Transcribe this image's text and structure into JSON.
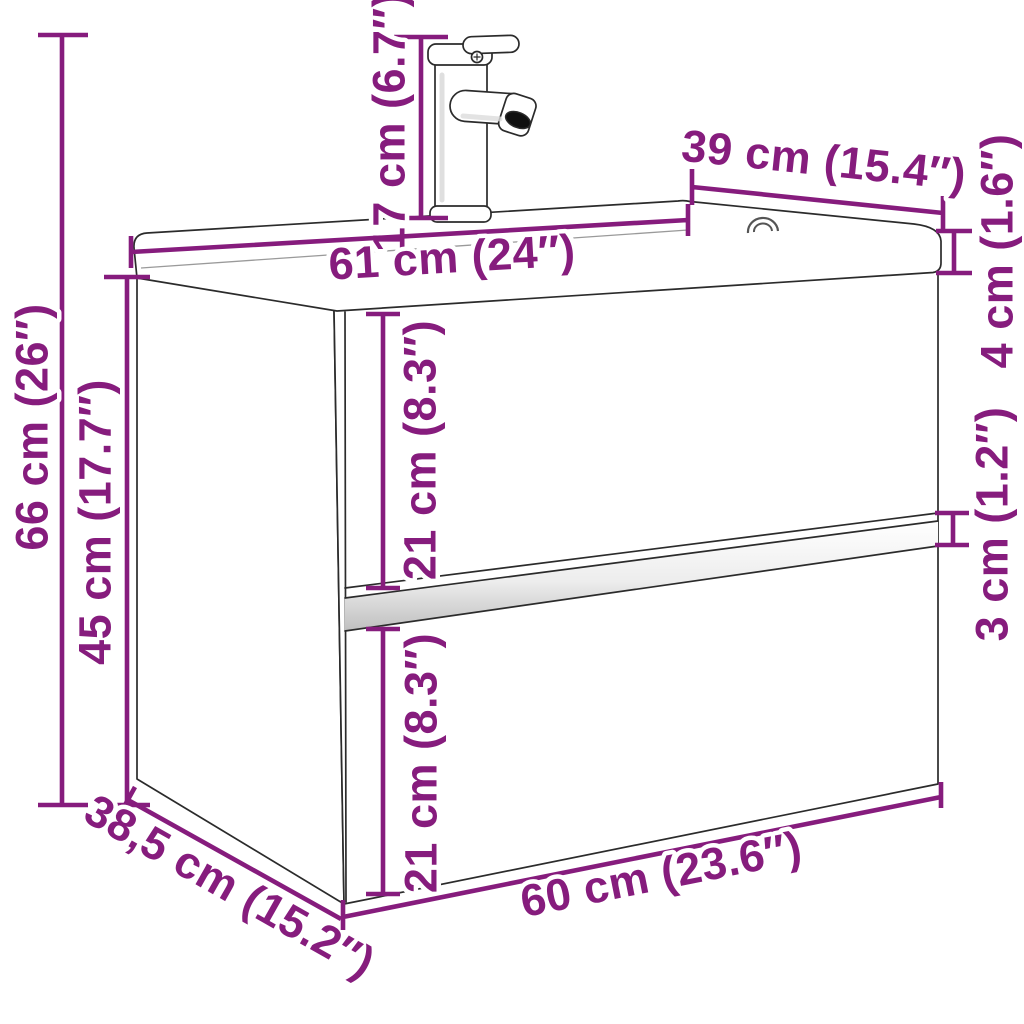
{
  "diagram": {
    "description": "Dimension diagram of a wall-hung bathroom vanity cabinet with two drawers, integrated washbasin top and faucet",
    "accent_color": "#861C7D",
    "line_color": "#2B2B2B",
    "background_color": "#FFFFFF",
    "units": [
      "cm",
      "inches"
    ],
    "labels": {
      "overall_height": "66 cm (26″)",
      "cabinet_height": "45 cm (17.7″)",
      "faucet_height": "17 cm (6.7″)",
      "basin_width": "61 cm (24″)",
      "basin_depth": "39 cm (15.4″)",
      "basin_thickness": "4 cm (1.6″)",
      "upper_drawer_height": "21 cm (8.3″)",
      "drawer_gap": "3 cm (1.2″)",
      "lower_drawer_height": "21 cm (8.3″)",
      "cabinet_depth": "38,5 cm (15.2″)",
      "cabinet_width": "60 cm (23.6″)"
    }
  }
}
